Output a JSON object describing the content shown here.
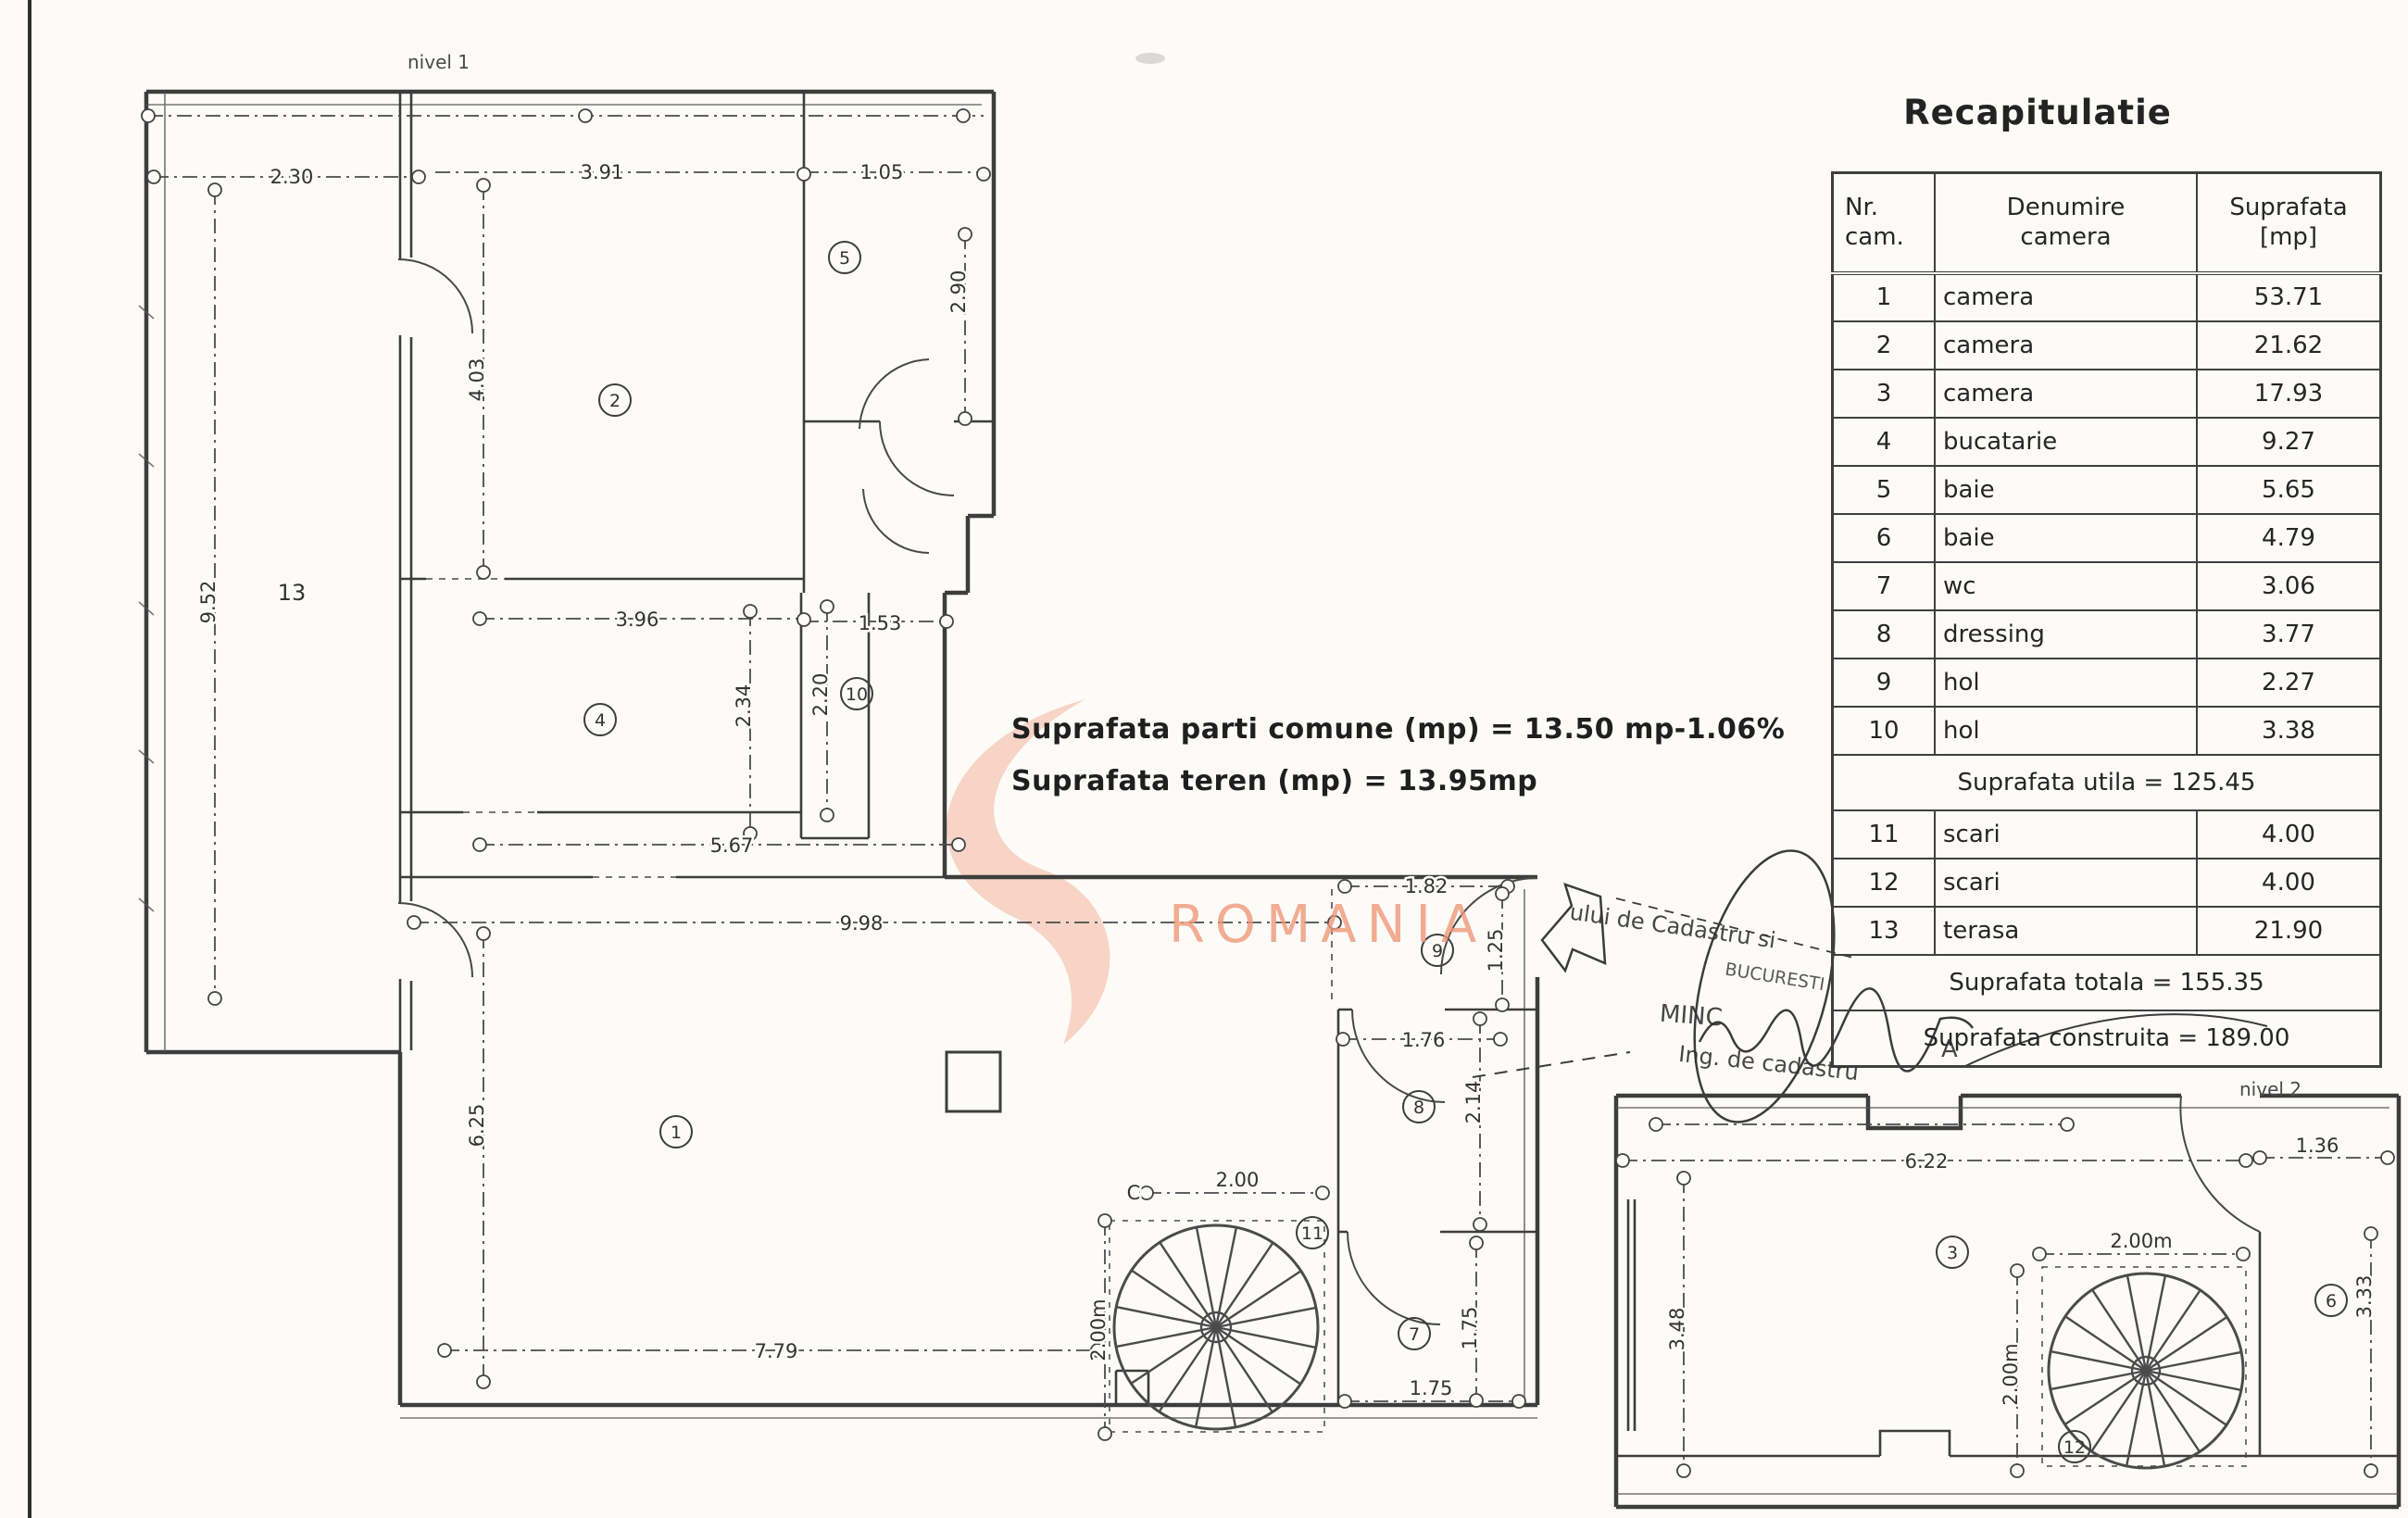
{
  "page": {
    "bg": "#fcfbf8",
    "ink": "#3d3d3d",
    "watermark_color": "#ee9878"
  },
  "watermark": {
    "text": "ROMANIA"
  },
  "summary": {
    "line1": "Suprafata parti comune (mp) = 13.50 mp-1.06%",
    "line2": "Suprafata teren (mp) = 13.95mp"
  },
  "recap": {
    "title": "Recapitulatie",
    "headers": {
      "c1a": "Nr.",
      "c1b": "cam.",
      "c2a": "Denumire",
      "c2b": "camera",
      "c3a": "Suprafata",
      "c3b": "[mp]"
    },
    "rows": [
      {
        "nr": "1",
        "name": "camera",
        "area": "53.71"
      },
      {
        "nr": "2",
        "name": "camera",
        "area": "21.62"
      },
      {
        "nr": "3",
        "name": "camera",
        "area": "17.93"
      },
      {
        "nr": "4",
        "name": "bucatarie",
        "area": "9.27"
      },
      {
        "nr": "5",
        "name": "baie",
        "area": "5.65"
      },
      {
        "nr": "6",
        "name": "baie",
        "area": "4.79"
      },
      {
        "nr": "7",
        "name": "wc",
        "area": "3.06"
      },
      {
        "nr": "8",
        "name": "dressing",
        "area": "3.77"
      },
      {
        "nr": "9",
        "name": "hol",
        "area": "2.27"
      },
      {
        "nr": "10",
        "name": "hol",
        "area": "3.38"
      }
    ],
    "utila": "Suprafata utila = 125.45",
    "rows2": [
      {
        "nr": "11",
        "name": "scari",
        "area": "4.00"
      },
      {
        "nr": "12",
        "name": "scari",
        "area": "4.00"
      },
      {
        "nr": "13",
        "name": "terasa",
        "area": "21.90"
      }
    ],
    "totala": "Suprafata totala = 155.35",
    "construita": "Suprafata construita = 189.00"
  },
  "stamp": {
    "l1": "ului de Cadastru si",
    "l2": "BUCURESTI",
    "l3": "MINC",
    "l4": "A",
    "l5": "Ing. de cadastru"
  },
  "plan1": {
    "label": "nivel 1",
    "rooms": {
      "r1": "1",
      "r2": "2",
      "r4": "4",
      "r5": "5",
      "r7": "7",
      "r8": "8",
      "r9": "9",
      "r10": "10",
      "r11": "11",
      "r13": "13"
    },
    "dims": {
      "d230": "2.30",
      "d391": "3.91",
      "d105": "1.05",
      "d952": "9.52",
      "d403": "4.03",
      "d290": "2.90",
      "d396": "3.96",
      "d153": "1.53",
      "d234": "2.34",
      "d220": "2.20",
      "d567": "5.67",
      "d998": "9.98",
      "d625": "6.25",
      "d779": "7.79",
      "d182": "1.82",
      "d125": "1.25",
      "d176": "1.76",
      "d214": "2.14",
      "dC": "C",
      "d200": "2.00",
      "d200m": "2.00m",
      "d175v": "1.75",
      "d175h": "1.75"
    }
  },
  "plan2": {
    "label": "nivel 2",
    "rooms": {
      "r3": "3",
      "r6": "6",
      "r12": "12"
    },
    "dims": {
      "d622": "6.22",
      "d136": "1.36",
      "d348": "3.48",
      "d200mh": "2.00m",
      "d200mv": "2.00m",
      "d333": "3.33"
    }
  }
}
